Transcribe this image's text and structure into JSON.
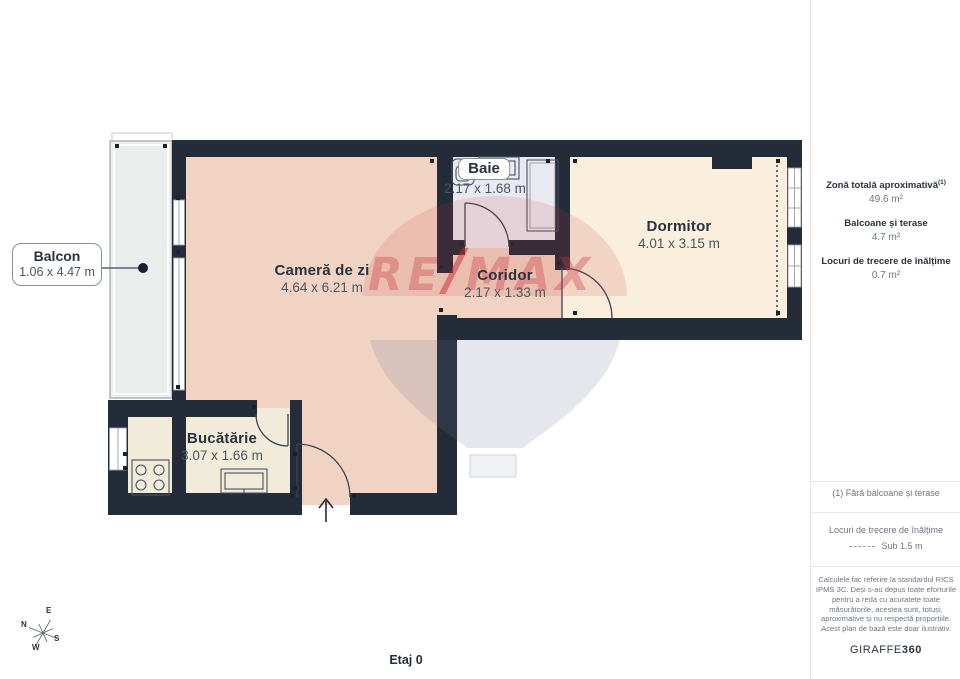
{
  "plan": {
    "floor_label": "Etaj 0",
    "rooms": {
      "balcon": {
        "name": "Balcon",
        "dims": "1.06 x 4.47 m"
      },
      "camera": {
        "name": "Cameră de zi",
        "dims": "4.64 x 6.21 m"
      },
      "baie": {
        "name": "Baie",
        "dims": "2.17 x 1.68 m"
      },
      "coridor": {
        "name": "Coridor",
        "dims": "2.17 x 1.33 m"
      },
      "dormitor": {
        "name": "Dormitor",
        "dims": "4.01 x 3.15 m"
      },
      "bucatarie": {
        "name": "Bucătărie",
        "dims": "3.07 x 1.66 m"
      }
    },
    "compass": {
      "n": "N",
      "e": "E",
      "s": "S",
      "w": "W"
    },
    "watermark": {
      "re": "RE",
      "slash": "/",
      "max": "MAX"
    }
  },
  "sidebar": {
    "total_area": {
      "label": "Zonă totală aproximativă",
      "footnote_marker": "(1)",
      "value": "49.6 m²"
    },
    "balconies": {
      "label": "Balcoane și terase",
      "value": "4.7 m²"
    },
    "low_clearance": {
      "label": "Locuri de trecere de înălțime",
      "value": "0.7 m²"
    },
    "footnote": "(1) Fără balcoane și terase",
    "legend": {
      "label": "Locuri de trecere de înălțime",
      "value": "Sub 1.5 m"
    },
    "disclaimer": "Calculele fac referire la standardul RICS IPMS 3C. Deși s-au depus toate eforturile pentru a reda cu acuratețe toate măsurătorile, acestea sunt, totuși, aproximative și nu respectă proporțiile. Acest plan de bază este doar ilustrativ.",
    "brand": {
      "name": "GIRAFFE",
      "suffix": "360"
    }
  },
  "colors": {
    "wall": "#242b39",
    "living": "#f1d3c3",
    "bedroom": "#faeedd",
    "kitchen": "#f1ecd9",
    "bathroom": "#e9eaf1",
    "balcony": "#ebecec",
    "text_dark": "#2a323f",
    "text_gray": "#6e7681",
    "watermark_red": "#c73e47"
  }
}
